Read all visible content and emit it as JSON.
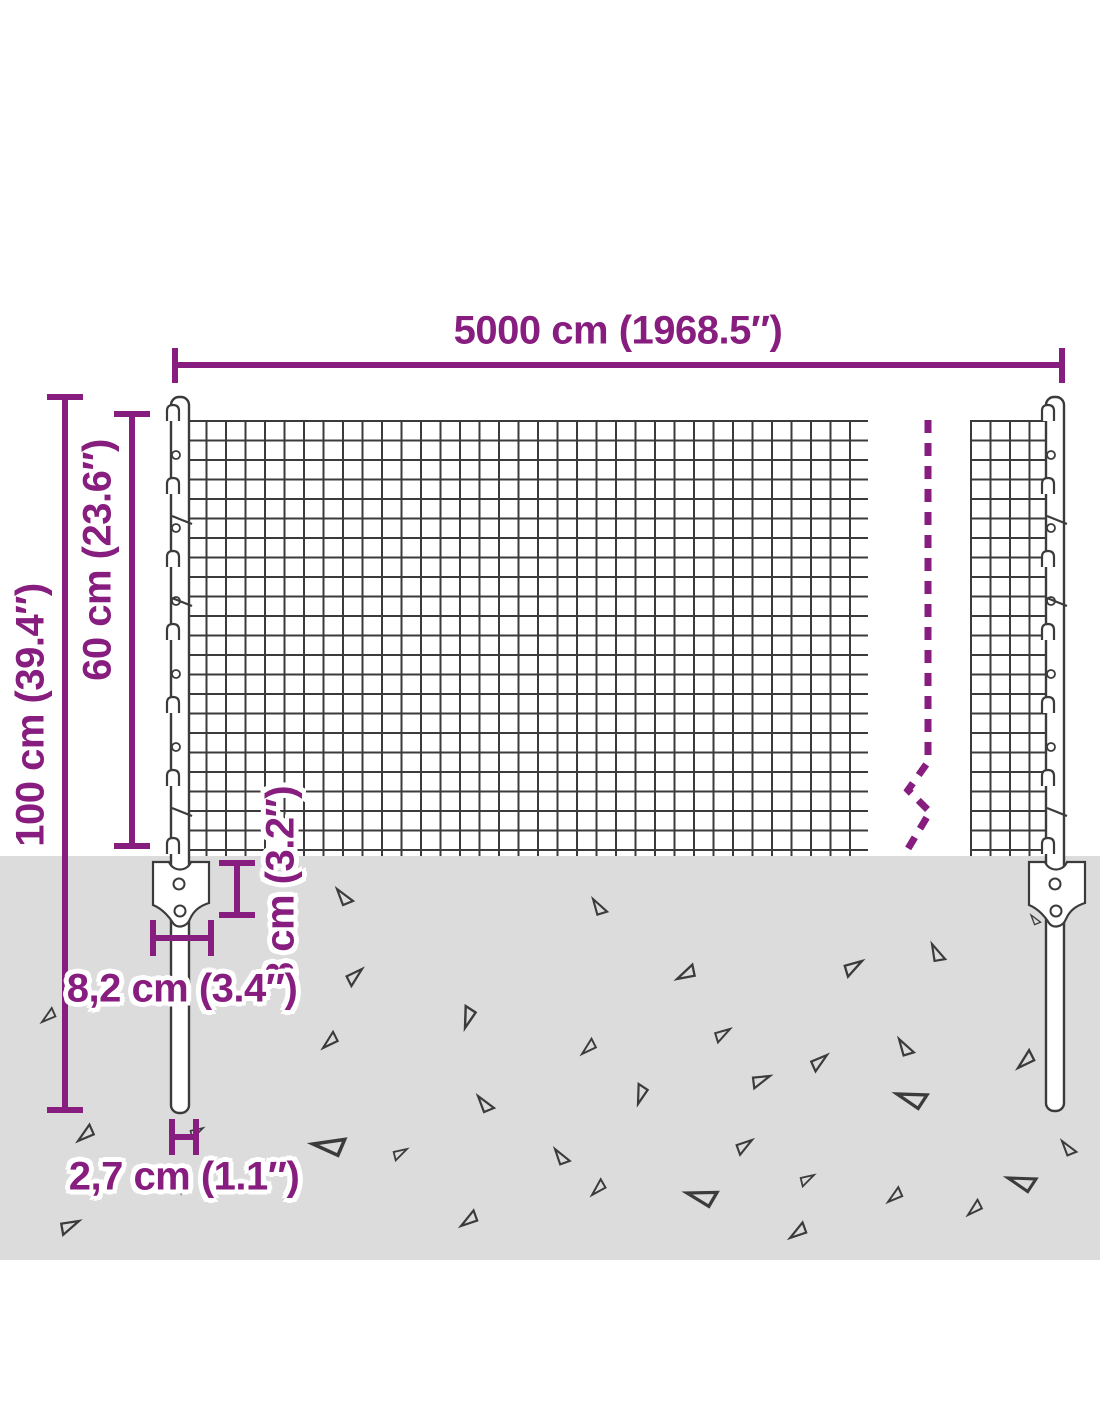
{
  "diagram": {
    "title": "wire-mesh-fence-dimension-diagram",
    "labels": {
      "total_width": "5000 cm (1968.5″)",
      "total_height": "100 cm (39.4″)",
      "mesh_height": "60 cm (23.6″)",
      "anchor_depth": "8 cm (3.2″)",
      "bracket_width": "8,2 cm (3.4″)",
      "post_diameter": "2,7 cm (1.1″)"
    },
    "colors": {
      "dimension_accent": "#871d7e",
      "ground": "#dcdcdc",
      "wire_line": "#3b3b3b",
      "background": "#ffffff"
    }
  }
}
